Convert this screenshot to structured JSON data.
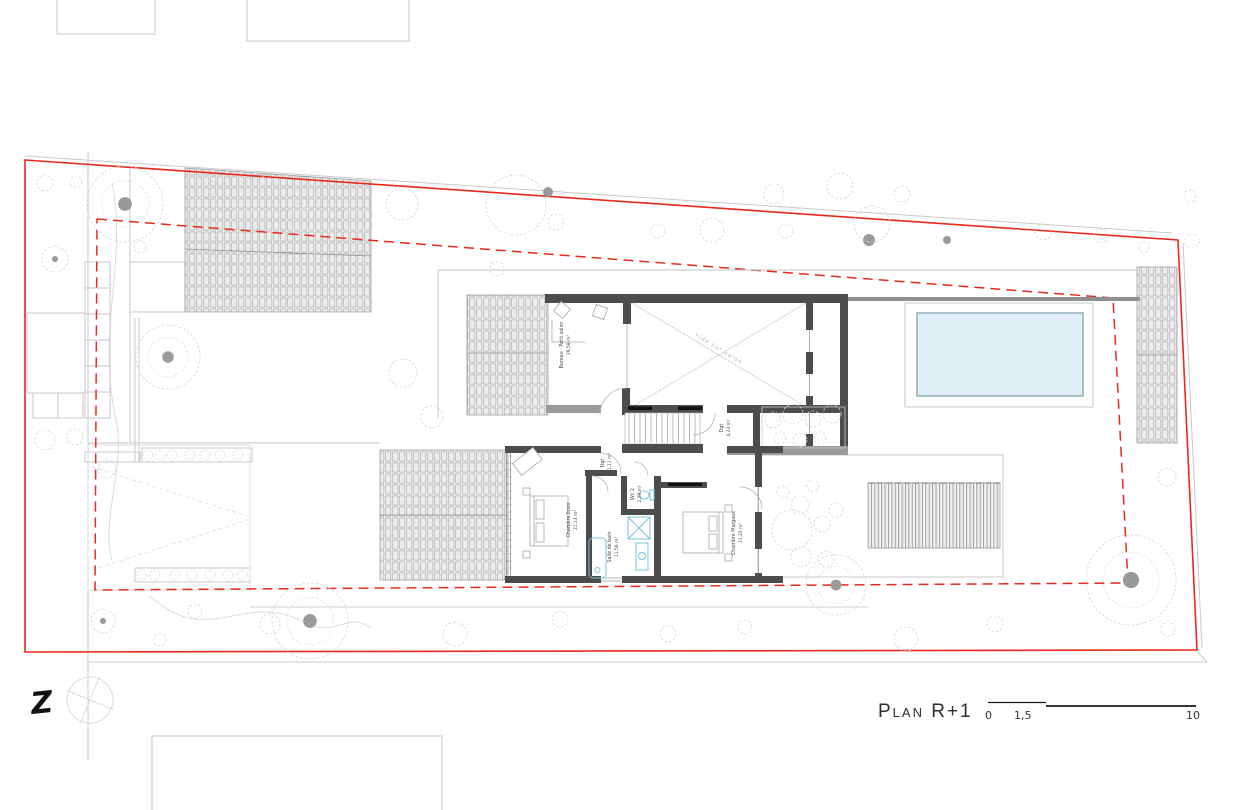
{
  "title": {
    "label": "Plan R+1"
  },
  "scale_bar": {
    "start": "0",
    "mid": "1,5",
    "end": "10"
  },
  "north": {
    "label": "Z"
  },
  "rooms": {
    "bureau": {
      "name": "Bureau - Petit salon",
      "area": "29,58 m²"
    },
    "void": {
      "name": "vide sur salon"
    },
    "dgt_stair": {
      "name": "Dgt",
      "area": "4,23 m²"
    },
    "dgt_hall": {
      "name": "Dgt",
      "area": "11,11 m²"
    },
    "wc": {
      "name": "Wc 2",
      "area": "2,28 m²"
    },
    "bathroom": {
      "name": "Salle de bain",
      "area": "11,56 m²"
    },
    "bedroom_left": {
      "name": "Chambre Enzo",
      "area": "21,13 m²"
    },
    "bedroom_right": {
      "name": "Chambre Margaux",
      "area": "21,20 m²"
    }
  },
  "colors": {
    "boundary_red": "#e8291c",
    "wall_dark": "#4d4d4d",
    "wall_medium": "#8f8f8f",
    "pool_fill": "#e2eef5",
    "pool_stroke": "#8aa9b4",
    "fixture_blue": "#79c3de",
    "hatch_gray": "#a0a0a0",
    "tree_gray": "#d4d4d4"
  }
}
